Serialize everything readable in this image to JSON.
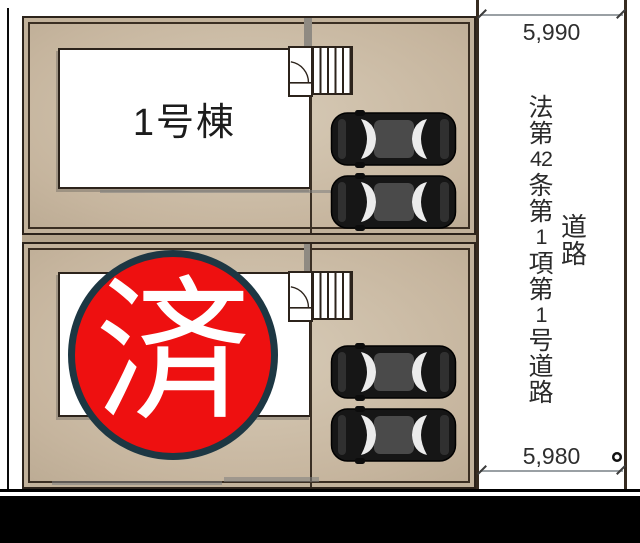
{
  "buildings": [
    {
      "label": "1号棟"
    }
  ],
  "stamp": {
    "text": "済",
    "fill_color": "#ee1010",
    "border_color": "#1d3743"
  },
  "road": {
    "regulation": {
      "text": "法第42条第1項第1号道路",
      "segments": [
        "法",
        "第",
        "42",
        "条",
        "第",
        "1",
        "項",
        "第",
        "1",
        "号",
        "道",
        "路"
      ]
    },
    "label": {
      "text": "道路",
      "segments": [
        "道",
        "路"
      ]
    }
  },
  "dimensions": {
    "top": "5,990",
    "bottom": "5,980"
  },
  "colors": {
    "plot_fill": "#c6b59e",
    "plot_border": "#2c231b",
    "dimension_line": "#9aa0a4",
    "bottom_band": "#000000"
  }
}
